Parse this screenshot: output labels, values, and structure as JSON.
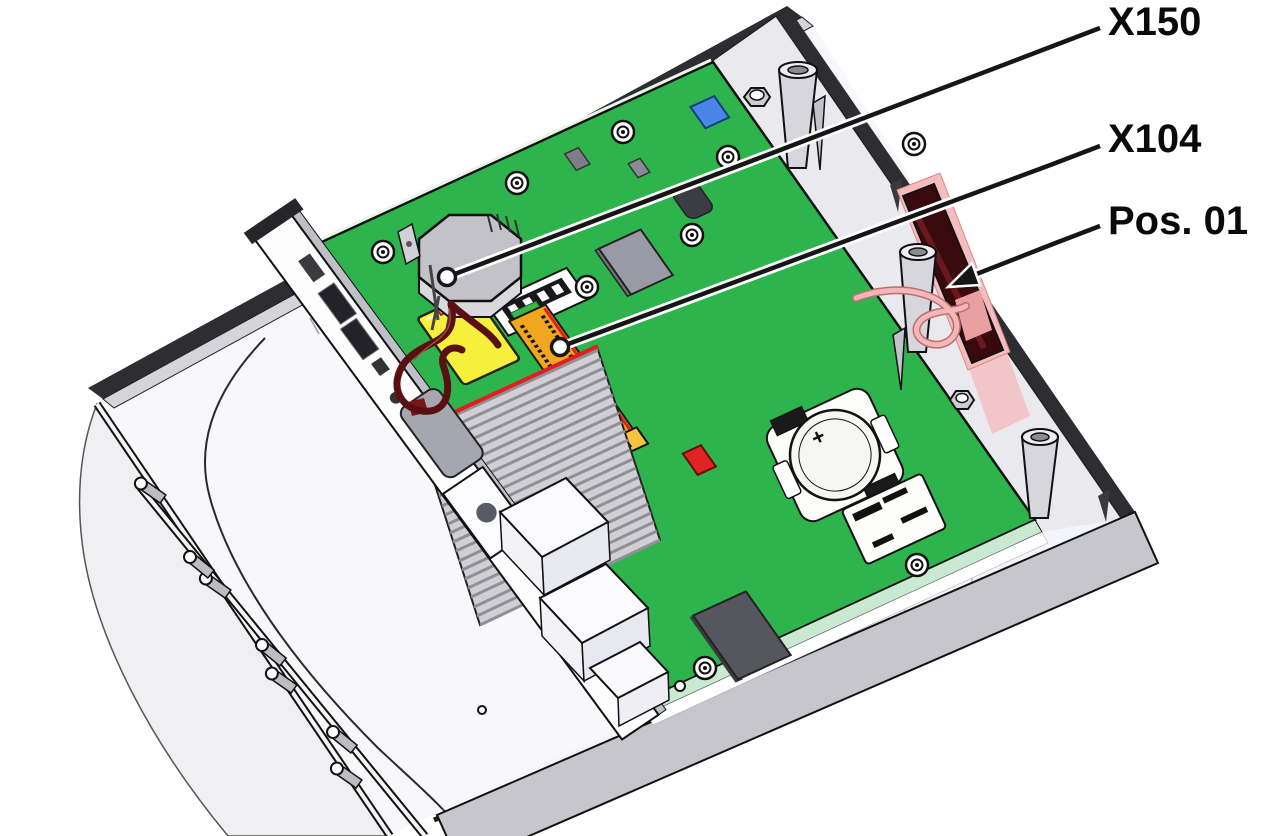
{
  "figure": {
    "type": "technical-illustration",
    "callouts": [
      {
        "label": "X150"
      },
      {
        "label": "X104"
      },
      {
        "label": "Pos. 01"
      }
    ],
    "battery_marking": "+",
    "colors": {
      "pcb_green": "#2eb44d",
      "connector_orange": "#f2a51e",
      "component_yellow": "#f6ef3c",
      "component_blue": "#4a86e8",
      "antenna_dark_red": "#380a0e",
      "wire_dark_red": "#591012",
      "callout_line": "#161616",
      "background": "#ffffff"
    }
  }
}
